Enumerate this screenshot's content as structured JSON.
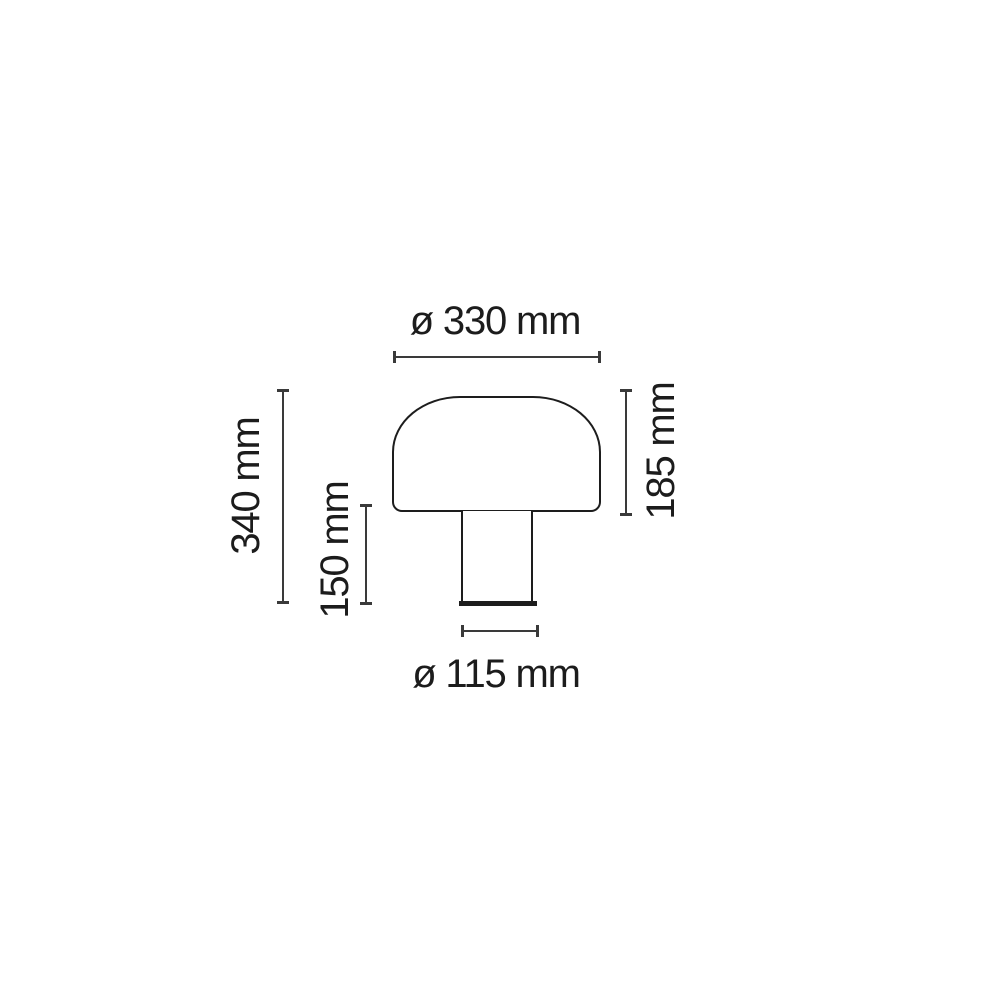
{
  "diagram": {
    "type": "product-dimension-drawing",
    "labels": {
      "shade_diameter": "ø 330 mm",
      "total_height": "340 mm",
      "stem_height": "150 mm",
      "shade_height": "185 mm",
      "base_diameter": "ø 115 mm"
    },
    "colors": {
      "background": "#ffffff",
      "outline": "#1d1d1d",
      "dimension_line": "#3a3a3a",
      "text": "#1c1c1c"
    }
  }
}
